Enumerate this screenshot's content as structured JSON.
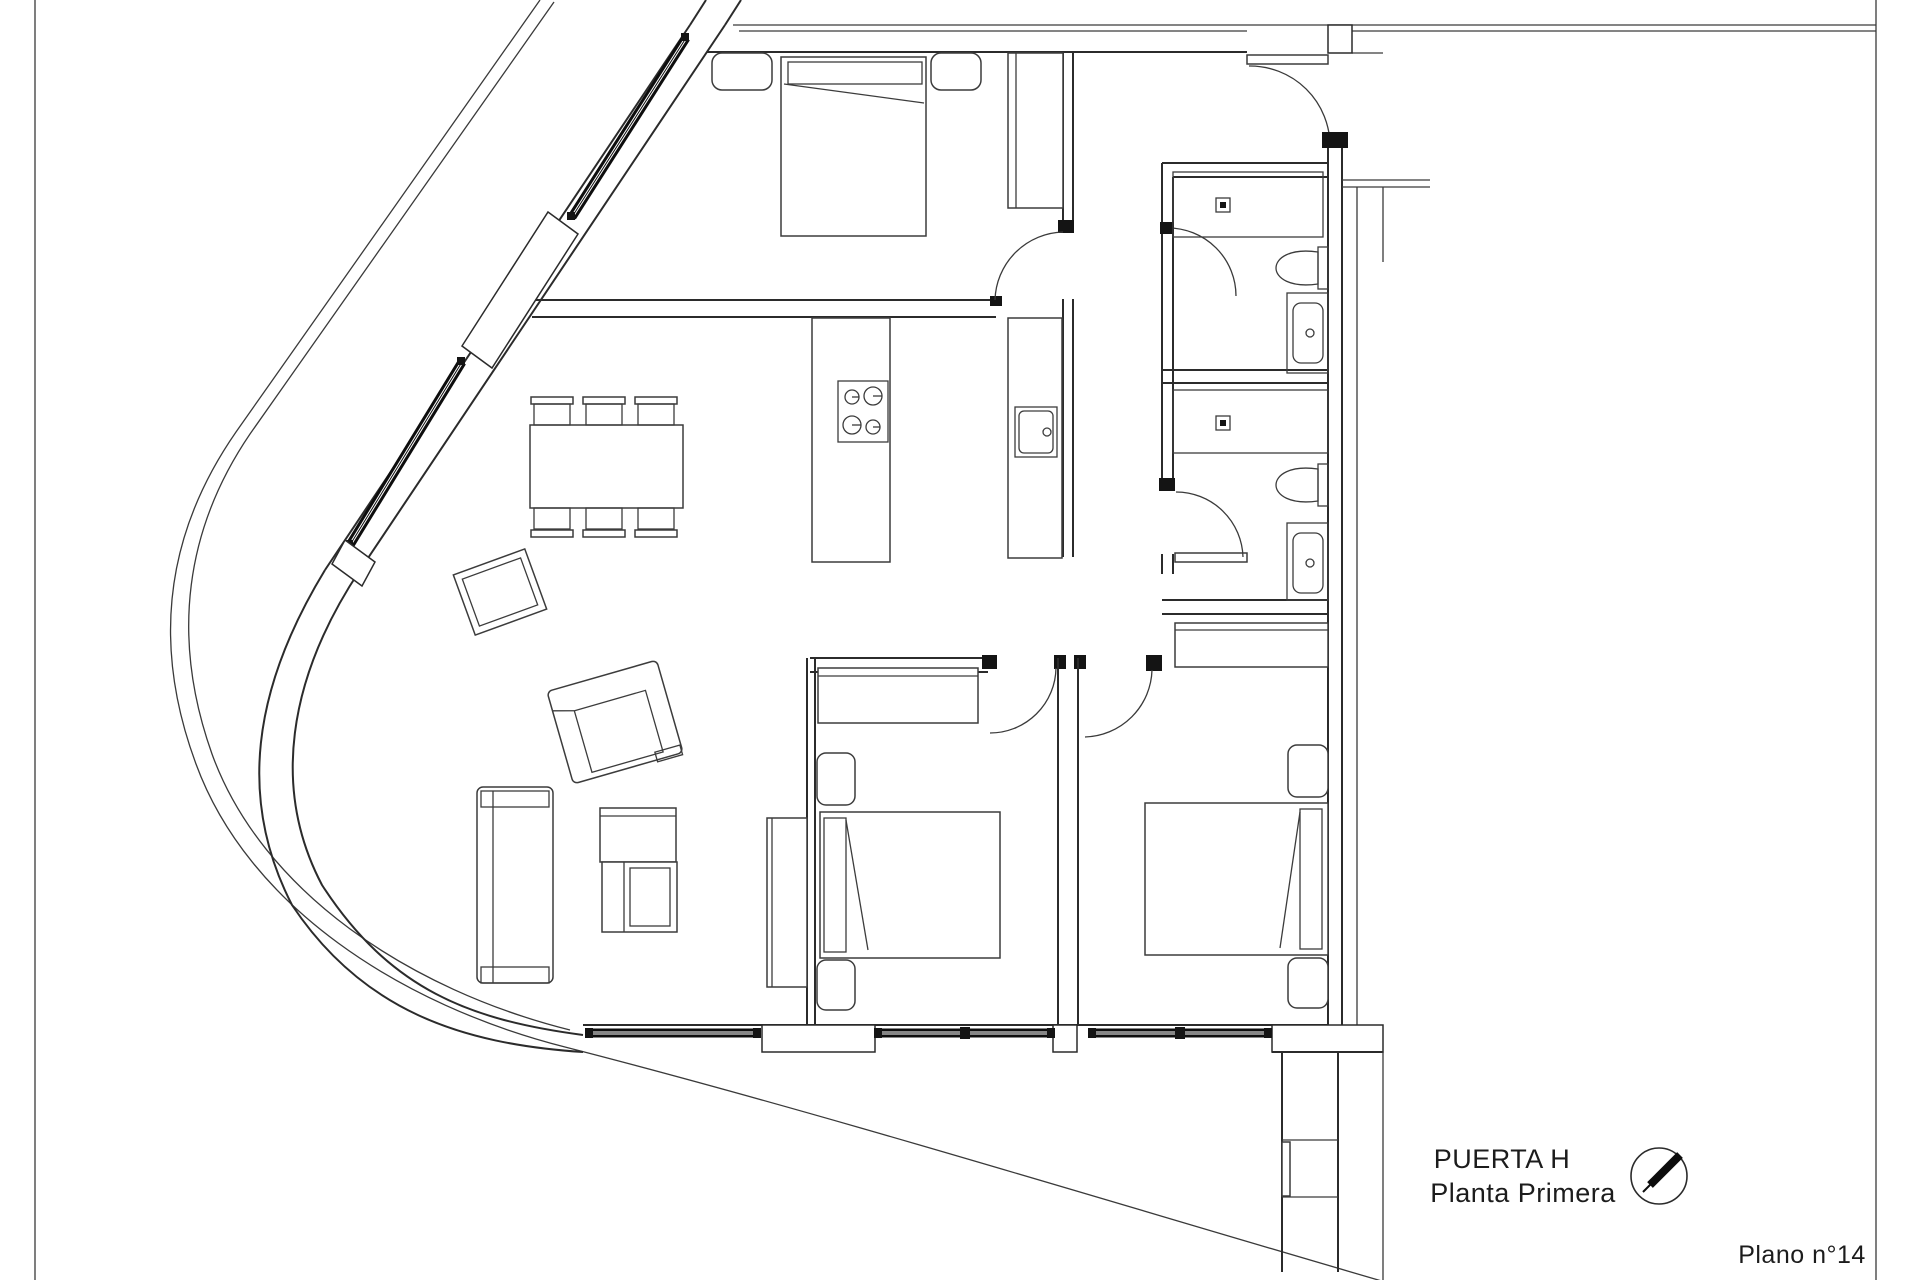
{
  "sheet": {
    "background_color": "#ffffff",
    "line_color": "#2b2b2b",
    "window_color": "#0d0d0d",
    "border_color": "#6e6e6e"
  },
  "title_block": {
    "unit_label": "PUERTA H",
    "floor_label": "Planta Primera",
    "sheet_label": "Plano n°14"
  },
  "north_indicator": {
    "icon": "compass-needle-icon",
    "needle_direction": "north-east"
  },
  "plan": {
    "type": "apartment-floor-plan",
    "rooms": [
      {
        "name": "master-bedroom",
        "furniture": [
          "double-bed",
          "nightstand-left",
          "nightstand-right",
          "wardrobe"
        ]
      },
      {
        "name": "kitchen-dining",
        "furniture": [
          "dining-table",
          "six-chairs",
          "kitchen-island-cooktop-4-burners",
          "counter-with-sink"
        ]
      },
      {
        "name": "hallway",
        "furniture": []
      },
      {
        "name": "bathroom-1",
        "fixtures": [
          "shower-with-drain",
          "toilet",
          "washbasin"
        ]
      },
      {
        "name": "bathroom-2",
        "fixtures": [
          "shower-with-drain",
          "toilet",
          "washbasin"
        ]
      },
      {
        "name": "bedroom-2",
        "furniture": [
          "wardrobe",
          "bed",
          "nightstand-top",
          "nightstand-bottom"
        ]
      },
      {
        "name": "bedroom-3",
        "furniture": [
          "wardrobe",
          "bed",
          "nightstand-top",
          "nightstand-bottom"
        ]
      },
      {
        "name": "living-room",
        "furniture": [
          "sofa",
          "nesting-coffee-tables",
          "tv-cabinet",
          "armchair",
          "rotated-side-table"
        ]
      },
      {
        "name": "terrace",
        "features": [
          "curved-parapet"
        ]
      },
      {
        "name": "service-shaft",
        "features": [
          "duct-hatch"
        ]
      }
    ],
    "doors": [
      "entry-door",
      "master-bedroom-door",
      "bathroom-1-door",
      "bathroom-2-door",
      "bedroom-2-door",
      "bedroom-3-door"
    ],
    "windows": [
      "facade-window-upper-diagonal",
      "facade-window-lower-diagonal",
      "south-window-1",
      "south-window-2",
      "south-window-3"
    ]
  }
}
